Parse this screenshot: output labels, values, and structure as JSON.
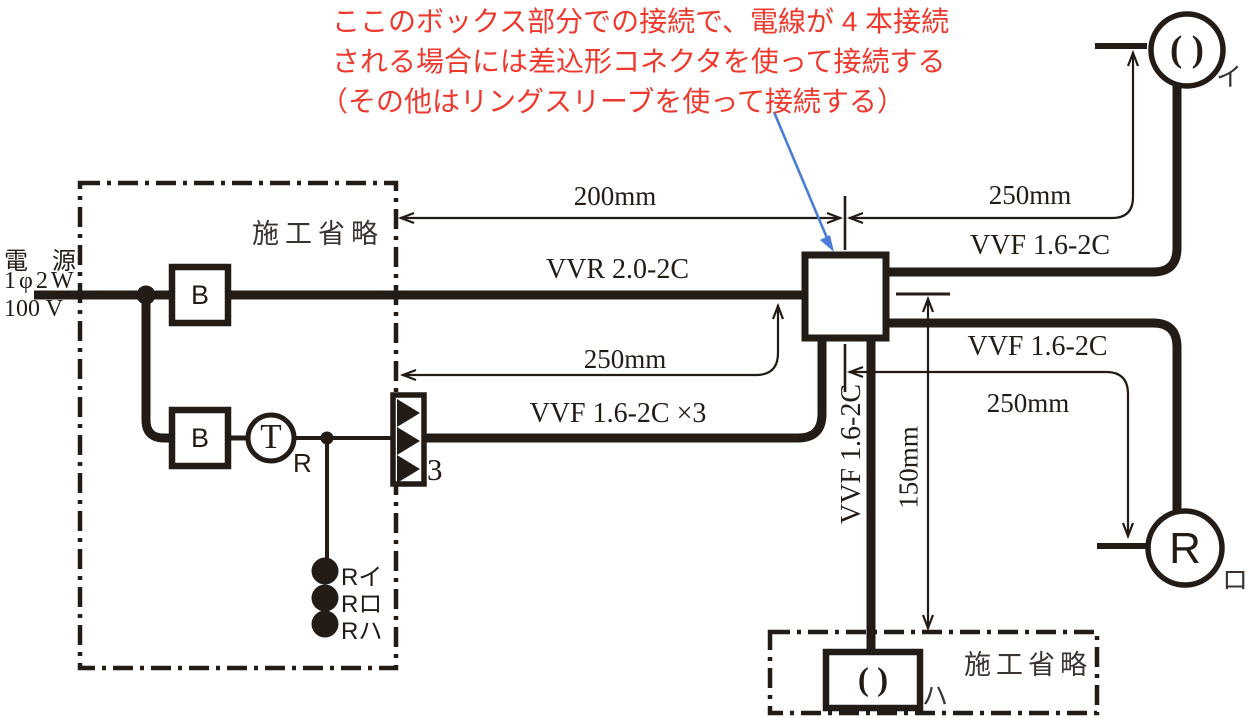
{
  "annotation": {
    "line1": "ここのボックス部分での接続で、電線が 4 本接続",
    "line2": "される場合には差込形コネクタを使って接続する",
    "line3": "（その他はリングスリーブを使って接続する）"
  },
  "power": {
    "name_line": "電　源",
    "phase_line": "1φ2W",
    "voltage_line": "100 V"
  },
  "omission": {
    "left": "施工省略",
    "bottom": "施工省略"
  },
  "devices": {
    "breaker1": "B",
    "breaker2": "B",
    "transformer": "T",
    "transformer_sub": "R",
    "relay_count": "3",
    "lamp_r": "R",
    "ceiling_symbol_i": "( )",
    "ceiling_symbol_ha": "( )"
  },
  "remote_switches": [
    "Rイ",
    "Rロ",
    "Rハ"
  ],
  "terminal_labels": {
    "i": "イ",
    "ro": "ロ",
    "ha": "ハ"
  },
  "cables": {
    "vvr": "VVR 2.0-2C",
    "vvf_x3": "VVF 1.6-2C ×3",
    "vvf_top": "VVF 1.6-2C",
    "vvf_right": "VVF 1.6-2C",
    "vvf_down": "VVF 1.6-2C"
  },
  "dimensions": {
    "top_left": "200mm",
    "top_right": "250mm",
    "mid_left": "250mm",
    "mid_right": "250mm",
    "vertical": "150mm"
  },
  "colors": {
    "ink": "#231b16",
    "annotation_red": "#ee3a2e",
    "arrow_blue": "#4a7ed6"
  }
}
